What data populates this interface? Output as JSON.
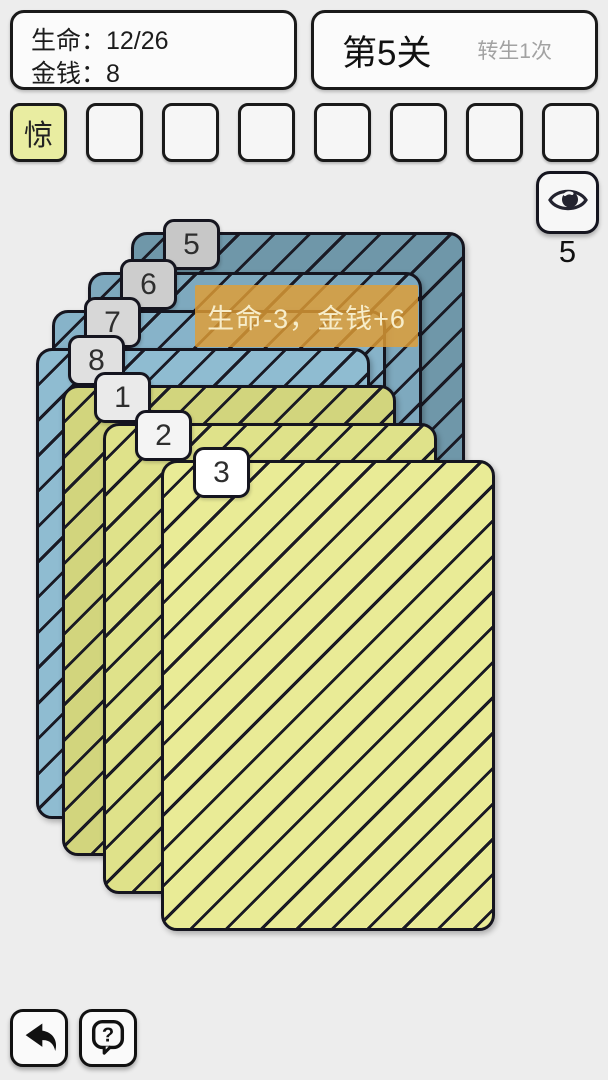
{
  "header": {
    "stats": {
      "life": "生命：12/26",
      "money": "金钱：8"
    },
    "level": {
      "title": "第5关",
      "rebirth_note": "转生1次"
    }
  },
  "buff_slots": {
    "filled_bg": "#e9eda1",
    "items": [
      {
        "label": "惊",
        "filled": true
      },
      {
        "label": "",
        "filled": false
      },
      {
        "label": "",
        "filled": false
      },
      {
        "label": "",
        "filled": false
      },
      {
        "label": "",
        "filled": false
      },
      {
        "label": "",
        "filled": false
      },
      {
        "label": "",
        "filled": false
      },
      {
        "label": "",
        "filled": false
      }
    ]
  },
  "peek": {
    "icon": "eye-icon",
    "remaining": "5"
  },
  "card_stack": {
    "banner": {
      "text": "生命-3，金钱+6",
      "bg": "rgba(224,158,52,0.82)",
      "fg": "#f7edca"
    },
    "cards": [
      {
        "number": "5",
        "face": "blue",
        "color": "#6f97a9",
        "tab_color": "#c7c7c7"
      },
      {
        "number": "6",
        "face": "blue",
        "color": "#7ea9be",
        "tab_color": "#cdcdcd"
      },
      {
        "number": "7",
        "face": "blue",
        "color": "#87b3c9",
        "tab_color": "#d7d7d7"
      },
      {
        "number": "8",
        "face": "blue",
        "color": "#8fbcd1",
        "tab_color": "#e0e0e0"
      },
      {
        "number": "1",
        "face": "yellow",
        "color": "#d2d57d",
        "tab_color": "#eaeaea"
      },
      {
        "number": "2",
        "face": "yellow",
        "color": "#dfe28a",
        "tab_color": "#f4f4f4"
      },
      {
        "number": "3",
        "face": "yellow",
        "color": "#e9eb96",
        "tab_color": "#ffffff"
      }
    ]
  },
  "footer": {
    "back_icon": "back-arrow-icon",
    "help_icon": "help-bubble-icon"
  }
}
